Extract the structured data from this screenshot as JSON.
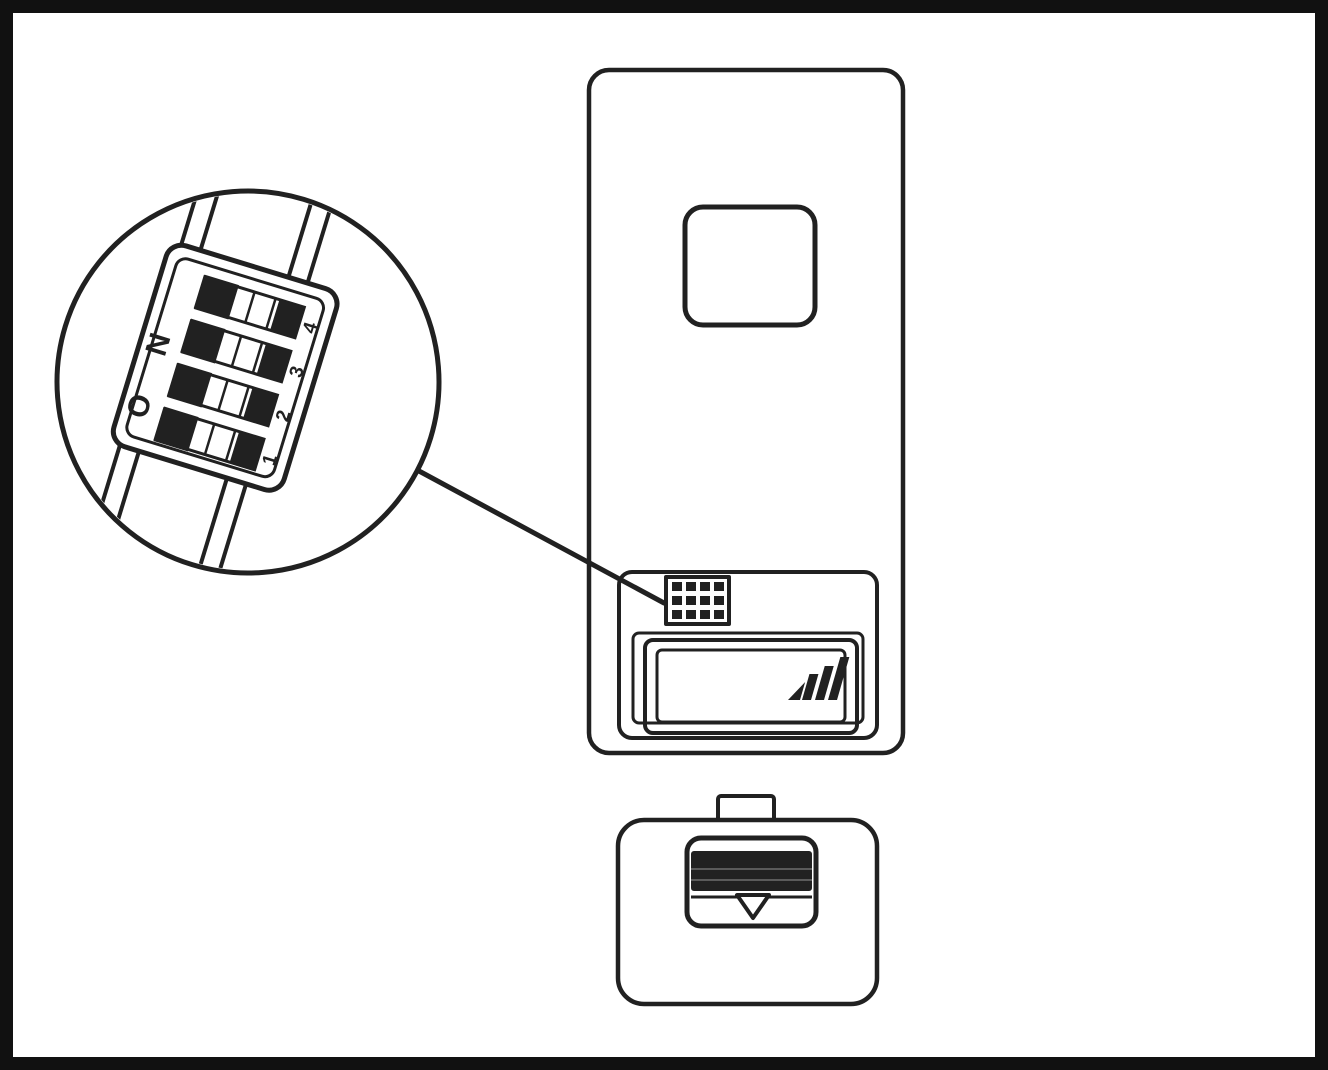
{
  "figure": {
    "kind": "instruction-line-drawing",
    "colors": {
      "ink": "#212121",
      "paper": "#ffffff"
    },
    "magnified_view": {
      "dip_label": "ON",
      "switch_numbers": [
        "4",
        "3",
        "2",
        "1"
      ]
    },
    "parts": [
      "transmitter-body",
      "transmitter-button",
      "battery-compartment",
      "dip-switch-block",
      "magnifier-circle",
      "battery-cover",
      "battery-cover-latch"
    ]
  }
}
